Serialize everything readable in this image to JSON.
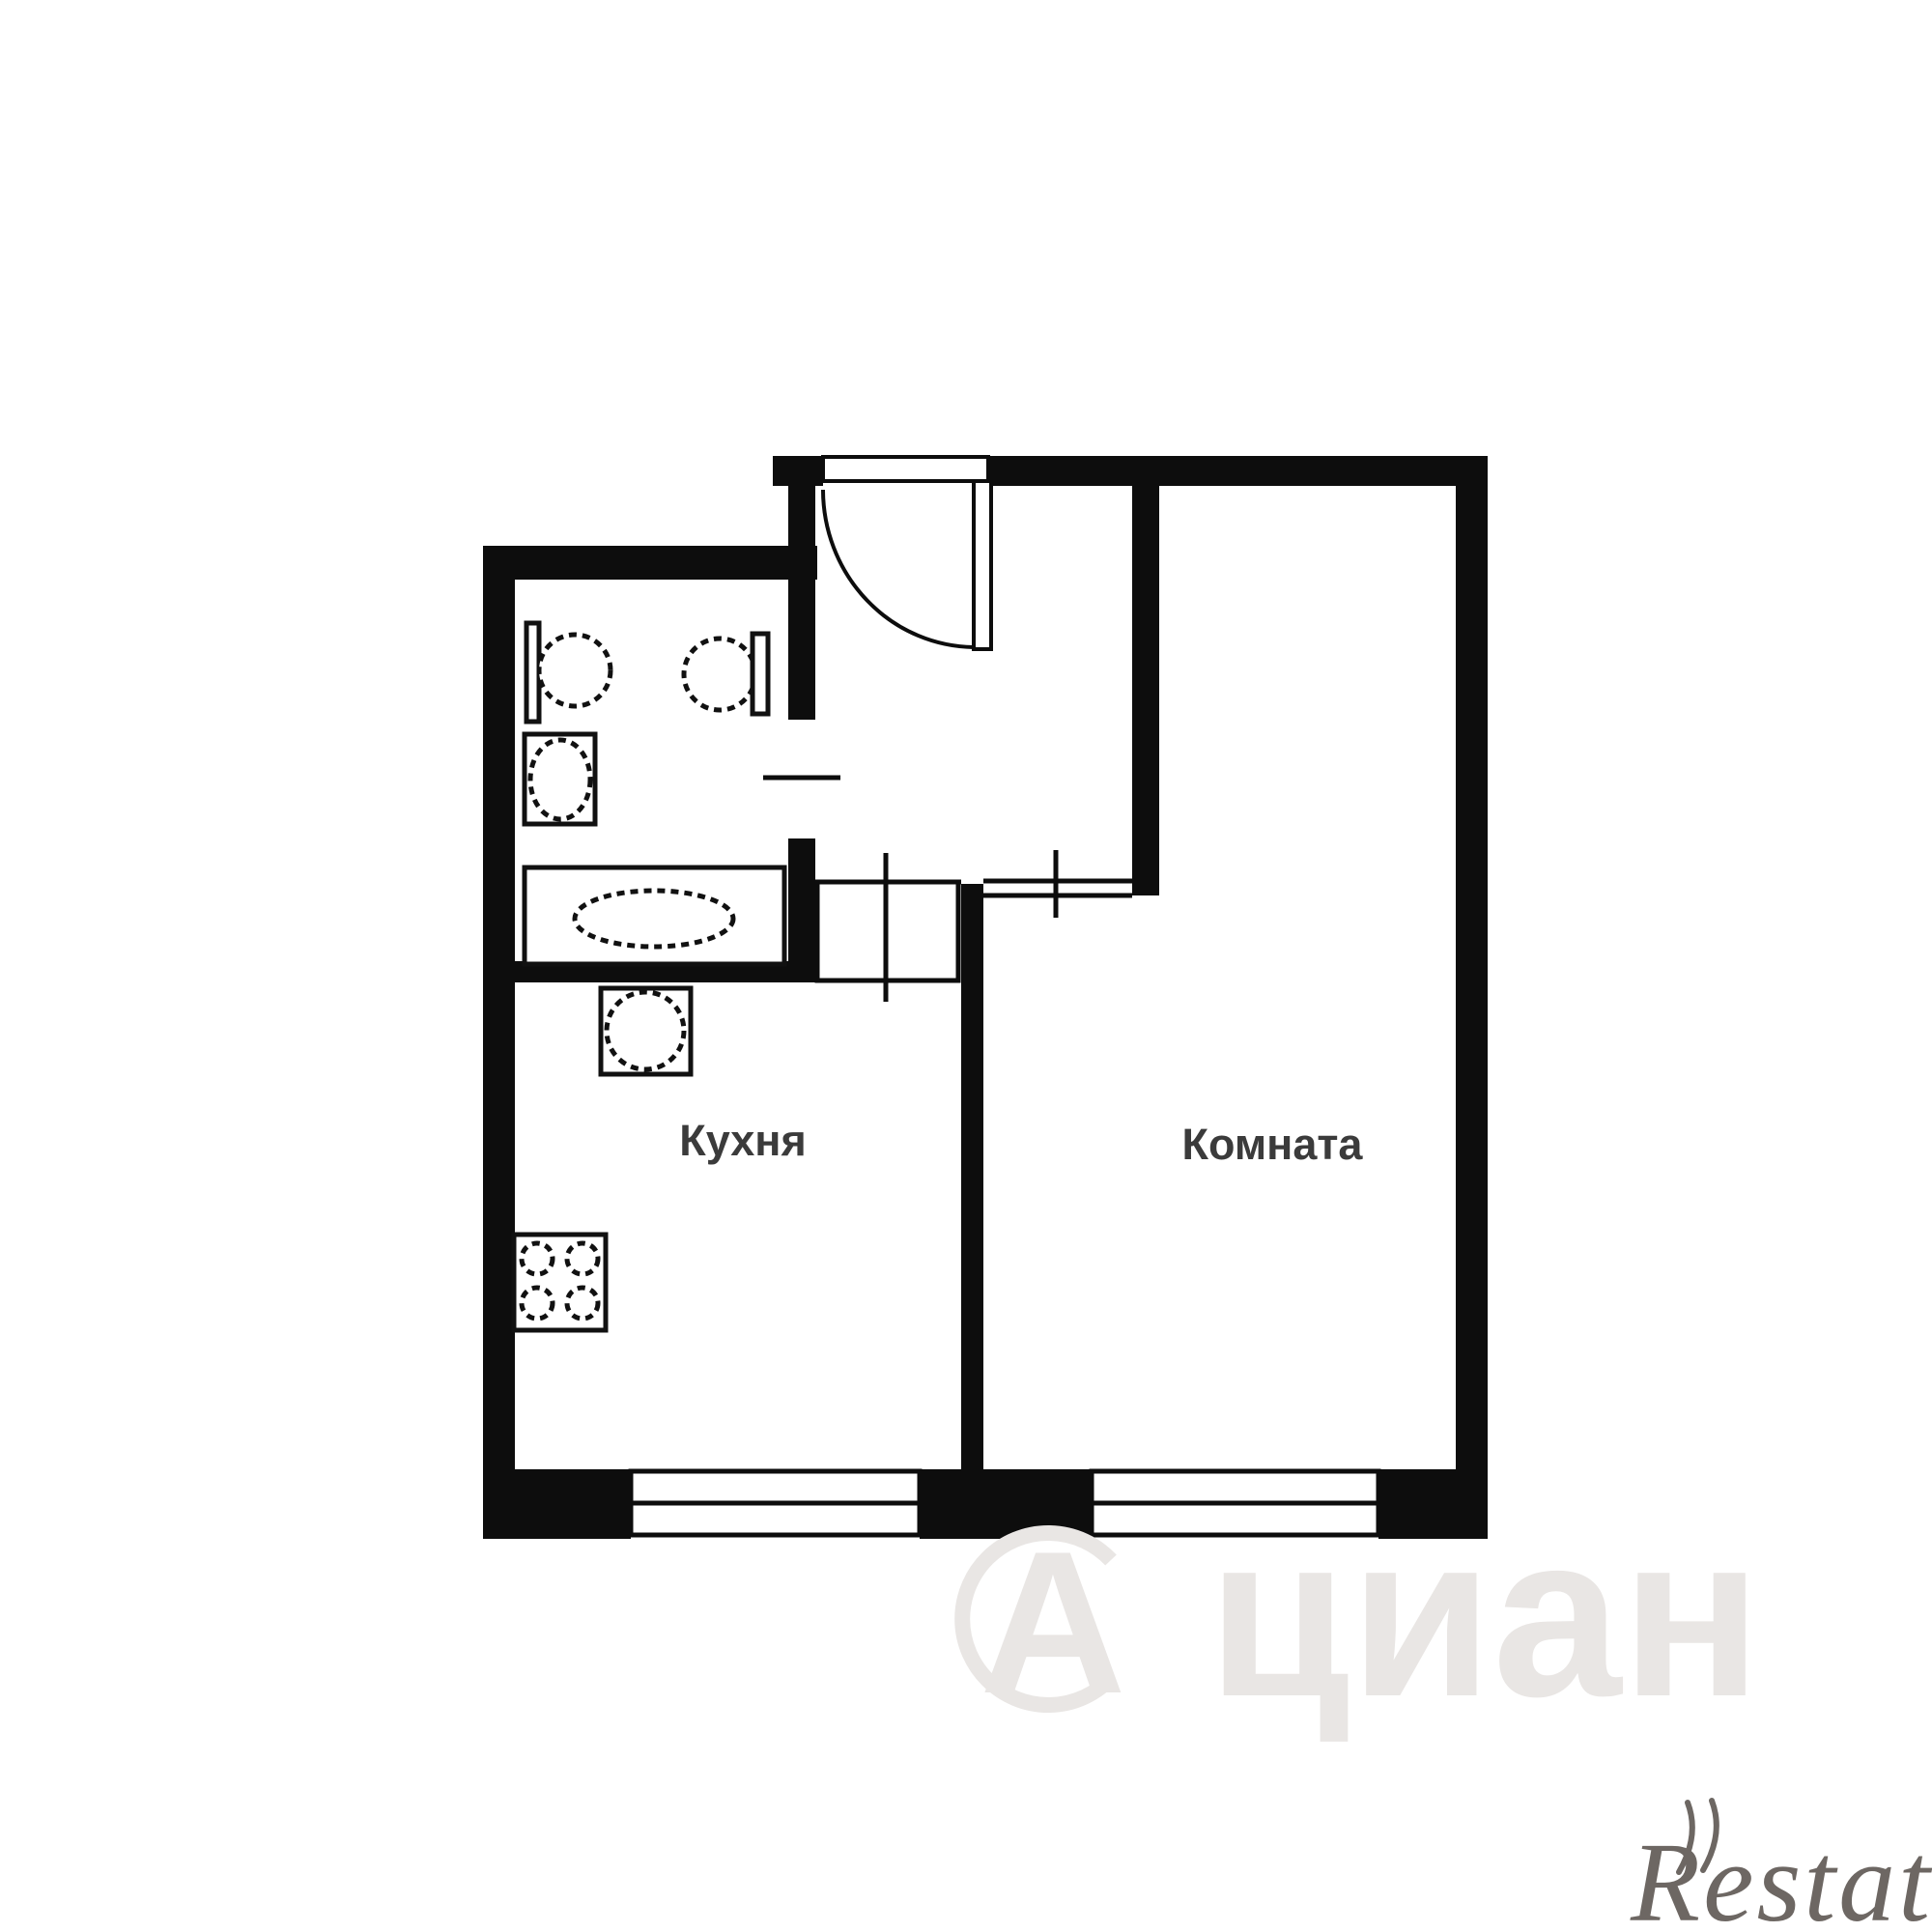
{
  "document": {
    "type": "apartment-floor-plan",
    "description": "Black and white one-room apartment floor plan with entrance hall, bathroom, kitchen and living room"
  },
  "rooms": {
    "kitchen": {
      "label": "Кухня"
    },
    "living_room": {
      "label": "Комната"
    }
  },
  "fixtures": {
    "bathroom": [
      "washbasin",
      "toilet",
      "washing-machine",
      "bathtub"
    ],
    "kitchen": [
      "kitchen-sink",
      "stove-4-burner"
    ],
    "openings": [
      "entrance-door-with-swing-arc",
      "bathroom-door-tick",
      "kitchen-passage-tick",
      "room-doorway-tick",
      "kitchen-window",
      "room-window"
    ]
  },
  "watermarks": {
    "cian": {
      "symbol": "А",
      "text": "циан"
    },
    "restate": {
      "text": "Restate"
    }
  },
  "colors": {
    "wall": "#0d0d0d",
    "background": "#ffffff",
    "room_label": "#3b3b3b",
    "watermark_cian": "#e9e6e4",
    "watermark_restate": "#5a534e"
  }
}
